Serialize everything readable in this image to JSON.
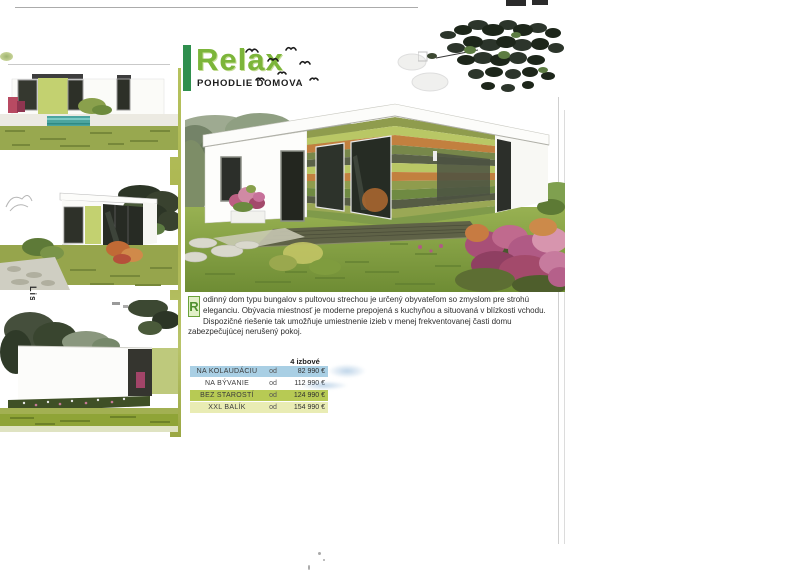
{
  "header": {
    "title": "Relax",
    "subtitle": "POHODLIE DOMOVA"
  },
  "sidebar": {
    "vertical_label": "List",
    "thumbnails": [
      {
        "name": "front-view-with-pool"
      },
      {
        "name": "side-corner-view"
      },
      {
        "name": "rear-view"
      }
    ]
  },
  "description": {
    "drop_cap": "R",
    "body": "odinný dom typu bungalov s pultovou strechou je určený obyvateľom so zmyslom pre strohú eleganciu. Obývacia miestnosť je moderne prepojená s kuchyňou a situovaná v blízkosti vchodu. Dispozičné riešenie tak umožňuje umiestnenie izieb v menej frekventovanej časti domu zabezpečujúcej nerušený pokoj."
  },
  "price_table": {
    "column_header": "4 izbové",
    "rows": [
      {
        "label": "NA KOLAUDÁCIU",
        "prefix": "od",
        "price": "82 990 €"
      },
      {
        "label": "NA BÝVANIE",
        "prefix": "od",
        "price": "112 990 €"
      },
      {
        "label": "BEZ STAROSTÍ",
        "prefix": "od",
        "price": "124 990 €"
      },
      {
        "label": "XXL BALÍK",
        "prefix": "od",
        "price": "154 990 €"
      }
    ],
    "row_colors": [
      "#a9cfe4",
      "#ffffff",
      "#b7ca54",
      "#e9ecb4"
    ]
  },
  "colors": {
    "title_green": "#7cb53a",
    "accent_bar_green": "#2f8f4e",
    "sidebar_strip_olive": "#b3bf5c"
  }
}
